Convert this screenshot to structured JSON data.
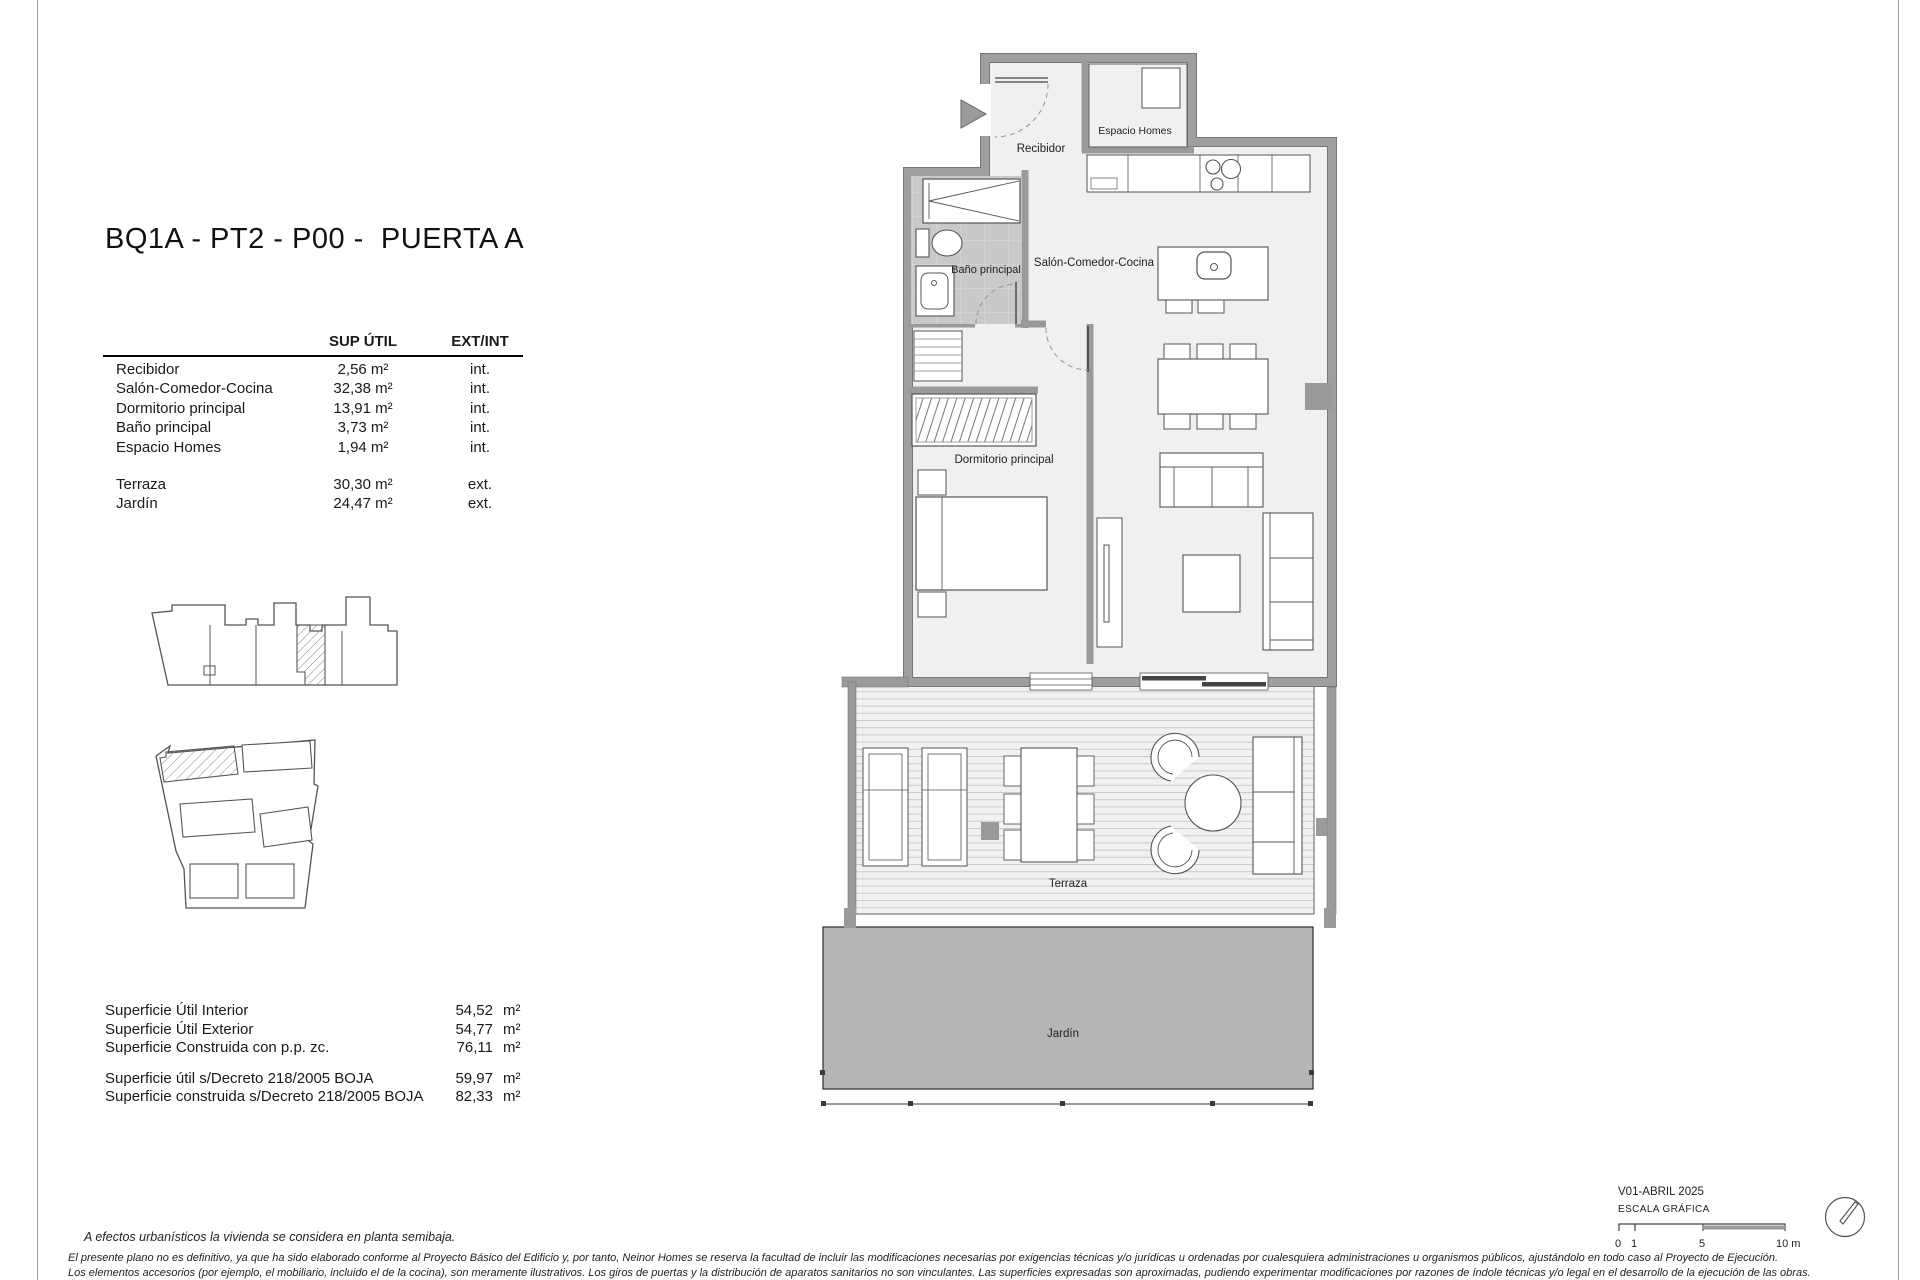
{
  "header": {
    "title": "BQ1A - PT2 - P00 -  PUERTA A"
  },
  "areas_table": {
    "col_area": "SUP ÚTIL",
    "col_type": "EXT/INT",
    "interior_rows": [
      {
        "label": "Recibidor",
        "area": "2,56 m²",
        "type": "int."
      },
      {
        "label": "Salón-Comedor-Cocina",
        "area": "32,38 m²",
        "type": "int."
      },
      {
        "label": "Dormitorio principal",
        "area": "13,91 m²",
        "type": "int."
      },
      {
        "label": "Baño principal",
        "area": "3,73 m²",
        "type": "int."
      },
      {
        "label": "Espacio Homes",
        "area": "1,94 m²",
        "type": "int."
      }
    ],
    "exterior_rows": [
      {
        "label": "Terraza",
        "area": "30,30 m²",
        "type": "ext."
      },
      {
        "label": "Jardín",
        "area": "24,47 m²",
        "type": "ext."
      }
    ]
  },
  "totals": {
    "group1": [
      {
        "label": "Superficie Útil Interior",
        "value": "54,52",
        "unit": "m²"
      },
      {
        "label": "Superficie Útil Exterior",
        "value": "54,77",
        "unit": "m²"
      },
      {
        "label": "Superficie Construida con p.p. zc.",
        "value": "76,11",
        "unit": "m²"
      }
    ],
    "group2": [
      {
        "label": "Superficie útil s/Decreto 218/2005 BOJA",
        "value": "59,97",
        "unit": "m²"
      },
      {
        "label": "Superficie construida s/Decreto 218/2005 BOJA",
        "value": "82,33",
        "unit": "m²"
      }
    ]
  },
  "plan_labels": {
    "recibidor": "Recibidor",
    "espacio_homes": "Espacio Homes",
    "bano": "Baño principal",
    "salon": "Salón-Comedor-Cocina",
    "dormitorio": "Dormitorio principal",
    "terraza": "Terraza",
    "jardin": "Jardín"
  },
  "notes": {
    "urban": "A efectos urbanísticos la vivienda se considera en planta semibaja.",
    "disclaimer1": "El presente plano no es definitivo, ya que ha sido elaborado conforme al Proyecto Básico del Edificio y, por tanto, Neinor Homes se reserva la facultad de incluir las modificaciones necesarias por exigencias técnicas y/o jurídicas u ordenadas por cualesquiera administraciones u organismos públicos, ajustándolo en todo caso al Proyecto de Ejecución.",
    "disclaimer2": "Los elementos accesorios (por ejemplo, el mobiliario, incluido el de la cocina), son meramente ilustrativos. Los giros de puertas y la distribución de aparatos sanitarios no son vinculantes. Las superficies expresadas son aproximadas, pudiendo experimentar modificaciones por razones de índole técnicas y/o legal en el desarrollo de la ejecución de las obras."
  },
  "title_block": {
    "version": "V01-ABRIL 2025",
    "scale_title": "ESCALA GRÁFICA",
    "ticks": [
      "0",
      "1",
      "5",
      "10 m"
    ]
  },
  "colors": {
    "wall": "#9a9a9a",
    "floor": "#f0f0f0",
    "tile": "#c9c9c9",
    "garden": "#b5b5b5"
  }
}
